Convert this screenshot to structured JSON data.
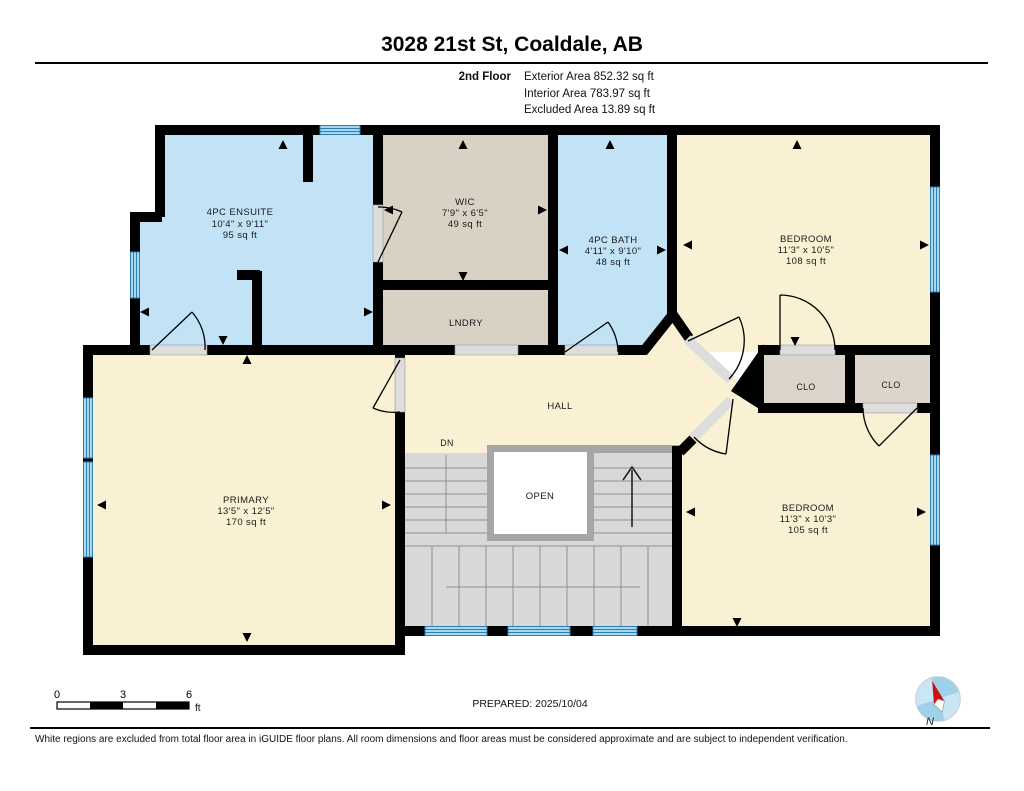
{
  "header": {
    "title": "3028 21st St, Coaldale, AB",
    "floor_label": "2nd Floor",
    "stats": [
      "Exterior Area 852.32 sq ft",
      "Interior Area 783.97 sq ft",
      "Excluded Area 13.89 sq ft"
    ]
  },
  "plan": {
    "rooms": [
      {
        "id": "ensuite",
        "name": "4PC ENSUITE",
        "dims": "10'4\" x 9'11\"",
        "area": "95 sq ft"
      },
      {
        "id": "wic",
        "name": "WIC",
        "dims": "7'9\" x 6'5\"",
        "area": "49 sq ft"
      },
      {
        "id": "bath",
        "name": "4PC BATH",
        "dims": "4'11\" x 9'10\"",
        "area": "48 sq ft"
      },
      {
        "id": "bedroom-1",
        "name": "BEDROOM",
        "dims": "11'3\" x 10'5\"",
        "area": "108 sq ft"
      },
      {
        "id": "laundry",
        "name": "LNDRY"
      },
      {
        "id": "hall",
        "name": "HALL"
      },
      {
        "id": "stairs-down",
        "label": "DN"
      },
      {
        "id": "stairwell-open",
        "label": "OPEN"
      },
      {
        "id": "closet-1",
        "name": "CLO"
      },
      {
        "id": "closet-2",
        "name": "CLO"
      },
      {
        "id": "primary",
        "name": "PRIMARY",
        "dims": "13'5\" x 12'5\"",
        "area": "170 sq ft"
      },
      {
        "id": "bedroom-2",
        "name": "BEDROOM",
        "dims": "11'3\" x 10'3\"",
        "area": "105 sq ft"
      }
    ],
    "colors": {
      "wall": "#000000",
      "room_cream": "#FAF0D4",
      "room_tan": "#D8D1C4",
      "room_blue": "#C2E2F5",
      "closet_gray": "#DBD5CB",
      "stair_gray": "#D8D8D8",
      "stair_wall_gray": "#A6A6A6",
      "window_fill": "#A8D8EF",
      "window_line": "#2C7FB5",
      "threshold": "#DDDDDD",
      "compass_blue": "#9FD2EA",
      "compass_red": "#CC1111"
    }
  },
  "scale_bar": {
    "tick_0": "0",
    "tick_3": "3",
    "tick_6": "6",
    "unit": "ft"
  },
  "prepared_label": "PREPARED: 2025/10/04",
  "compass": {
    "label": "N"
  },
  "footer": {
    "disclaimer": "White regions are excluded from total floor area in iGUIDE floor plans. All room dimensions and floor areas must be considered approximate and are subject to independent verification."
  }
}
